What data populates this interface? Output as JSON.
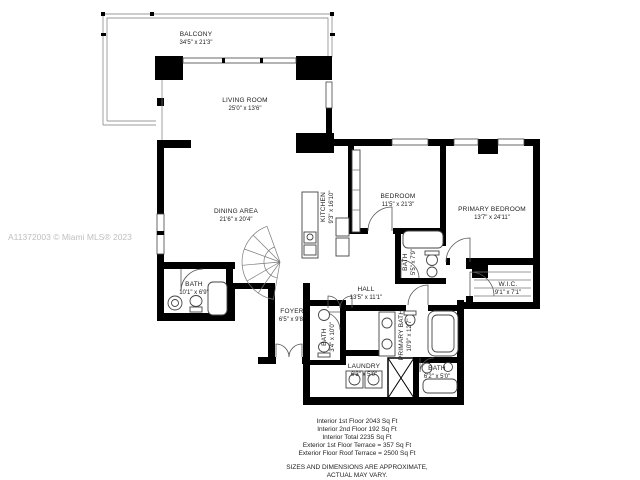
{
  "watermark": "A11372003 © Miami MLS® 2023",
  "rooms": {
    "balcony": {
      "name": "BALCONY",
      "dims": "34'5\" x 21'3\""
    },
    "living_room": {
      "name": "LIVING ROOM",
      "dims": "25'0\" x 13'6\""
    },
    "dining_area": {
      "name": "DINING AREA",
      "dims": "21'6\" x 20'4\""
    },
    "kitchen": {
      "name": "KITCHEN",
      "dims": "9'3\" x 16'10\""
    },
    "bedroom": {
      "name": "BEDROOM",
      "dims": "11'5\" x 21'3\""
    },
    "primary_bedroom": {
      "name": "PRIMARY BEDROOM",
      "dims": "13'7\" x 24'11\""
    },
    "bath_upper": {
      "name": "BATH",
      "dims": "5'5\" x 7'9\""
    },
    "wic": {
      "name": "W.I.C.",
      "dims": "9'1\" x 7'1\""
    },
    "bath_left": {
      "name": "BATH",
      "dims": "10'1\" x 6'9\""
    },
    "hall": {
      "name": "HALL",
      "dims": "13'5\" x 11'1\""
    },
    "foyer": {
      "name": "FOYER",
      "dims": "6'5\" x 9'8\""
    },
    "bath_powder": {
      "name": "BATH",
      "dims": "3'4\" x 10'0\""
    },
    "primary_bath": {
      "name": "PRIMARY BATH",
      "dims": "10'9\" x 12'7\""
    },
    "laundry": {
      "name": "LAUNDRY",
      "dims": "6'3\" x 5'0\""
    },
    "bath_guest": {
      "name": "BATH",
      "dims": "6'2\" x 5'0\""
    }
  },
  "footer": {
    "lines": [
      "Interior 1st Floor 2043 Sq Ft",
      "Interior 2nd Floor 192 Sq Ft",
      "Interior Total 2235 Sq Ft",
      "Exterior 1st Floor Terrace = 357 Sq Ft",
      "Exterior Floor Roof Terrace = 2500 Sq Ft"
    ],
    "disclaimer1": "SIZES AND DIMENSIONS ARE APPROXIMATE,",
    "disclaimer2": "ACTUAL MAY VARY."
  },
  "colors": {
    "wall": "#000000",
    "background": "#ffffff",
    "watermark": "#bfbfbf"
  }
}
